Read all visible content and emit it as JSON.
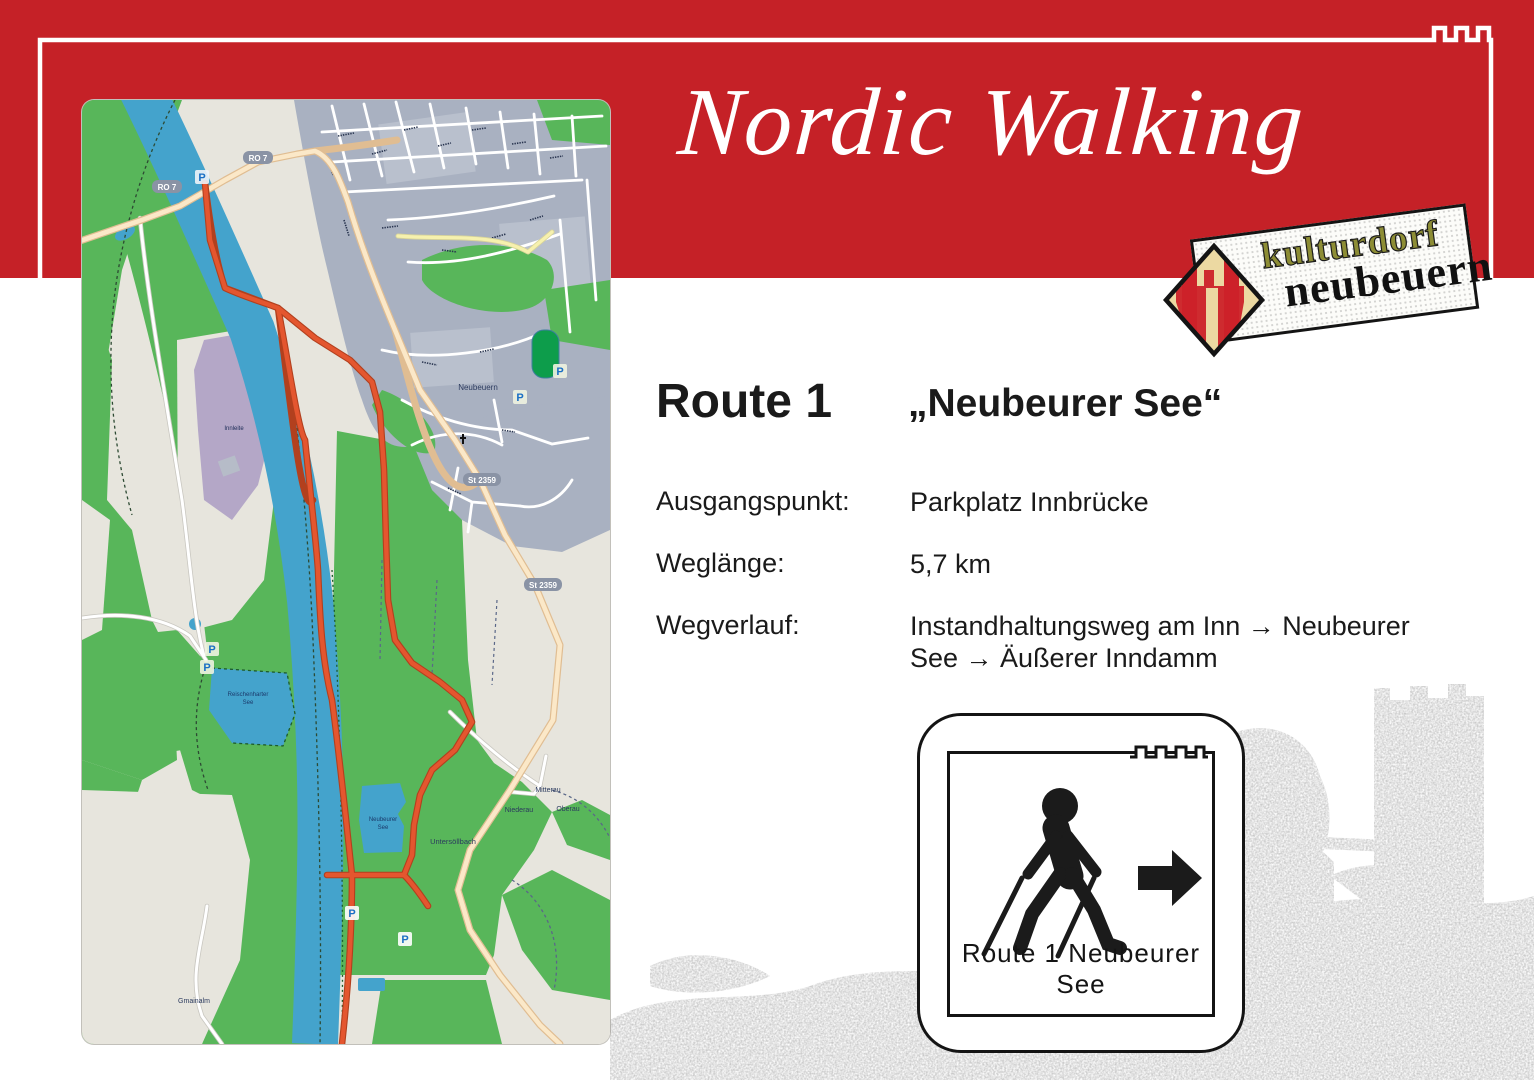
{
  "header": {
    "title": "Nordic Walking",
    "band_color": "#c52127"
  },
  "logo": {
    "line1": "kulturdorf",
    "line2": "neubeuern",
    "colors": {
      "word1": "#8d8d35",
      "word2": "#111111",
      "diamond_red": "#cc2229",
      "diamond_cream": "#ecd9a2"
    }
  },
  "route": {
    "heading": "Route 1",
    "name": "„Neubeurer See“",
    "fields": [
      {
        "label": "Ausgangspunkt:",
        "value": "Parkplatz Innbrücke"
      },
      {
        "label": "Weglänge:",
        "value": "5,7 km"
      },
      {
        "label": "Wegverlauf:",
        "value": "Instandhaltungsweg am Inn → Neubeurer See → Äußerer Inndamm",
        "lines": [
          "Instandhaltungsweg am Inn → Neubeurer",
          "See → Äußerer Inndamm"
        ]
      }
    ]
  },
  "sign": {
    "caption": "Route 1  Neubeurer See"
  },
  "map": {
    "parking_symbol": "P",
    "labels": [
      {
        "text": "Neubeuern"
      },
      {
        "text": "Innleite"
      },
      {
        "text": "Reischenharter"
      },
      {
        "text": "See"
      },
      {
        "text": "Neubeurer"
      },
      {
        "text": "See"
      },
      {
        "text": "Untersöllbach"
      },
      {
        "text": "Mitterau"
      },
      {
        "text": "Niederau"
      },
      {
        "text": "Oberau"
      },
      {
        "text": "Gmainalm"
      }
    ],
    "shields": [
      {
        "text": "RO 7"
      },
      {
        "text": "RO 7"
      },
      {
        "text": "St 2359"
      },
      {
        "text": "St 2359"
      }
    ],
    "colors": {
      "background": "#e7e5dd",
      "green": "#58b65a",
      "river": "#44a3cc",
      "urban": "#a9b1c1",
      "purple": "#b4a7c7",
      "road_beige": "#fbe8c8",
      "route_red": "#e4562f",
      "stadium_green": "#0d9d4b"
    }
  }
}
